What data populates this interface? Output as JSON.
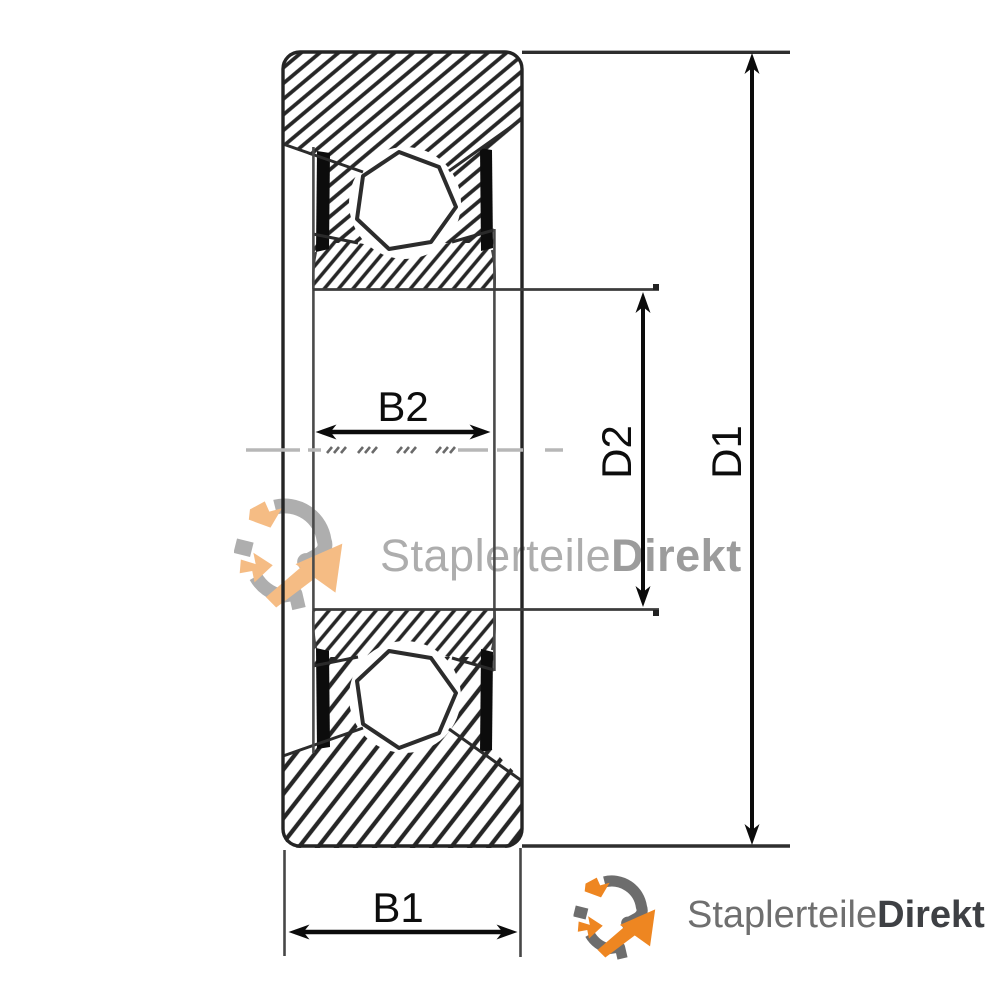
{
  "drawing": {
    "subject": "wheel bearing cross-section technical drawing",
    "labels": {
      "b1": "B1",
      "b2": "B2",
      "d1": "D1",
      "d2": "D2"
    }
  },
  "watermark": {
    "brand_regular": "Staplerteile",
    "brand_bold": "Direkt"
  },
  "footer_logo": {
    "brand_regular": "Staplerteile",
    "brand_bold": "Direkt"
  },
  "colors": {
    "brand_orange": "#EE8621",
    "logo_gray": "#6D6D6D",
    "brand_dark": "#3E4044",
    "watermark_text": "#ADADAD",
    "line_dark": "#242424",
    "dimension_black": "#0B0B0B"
  }
}
